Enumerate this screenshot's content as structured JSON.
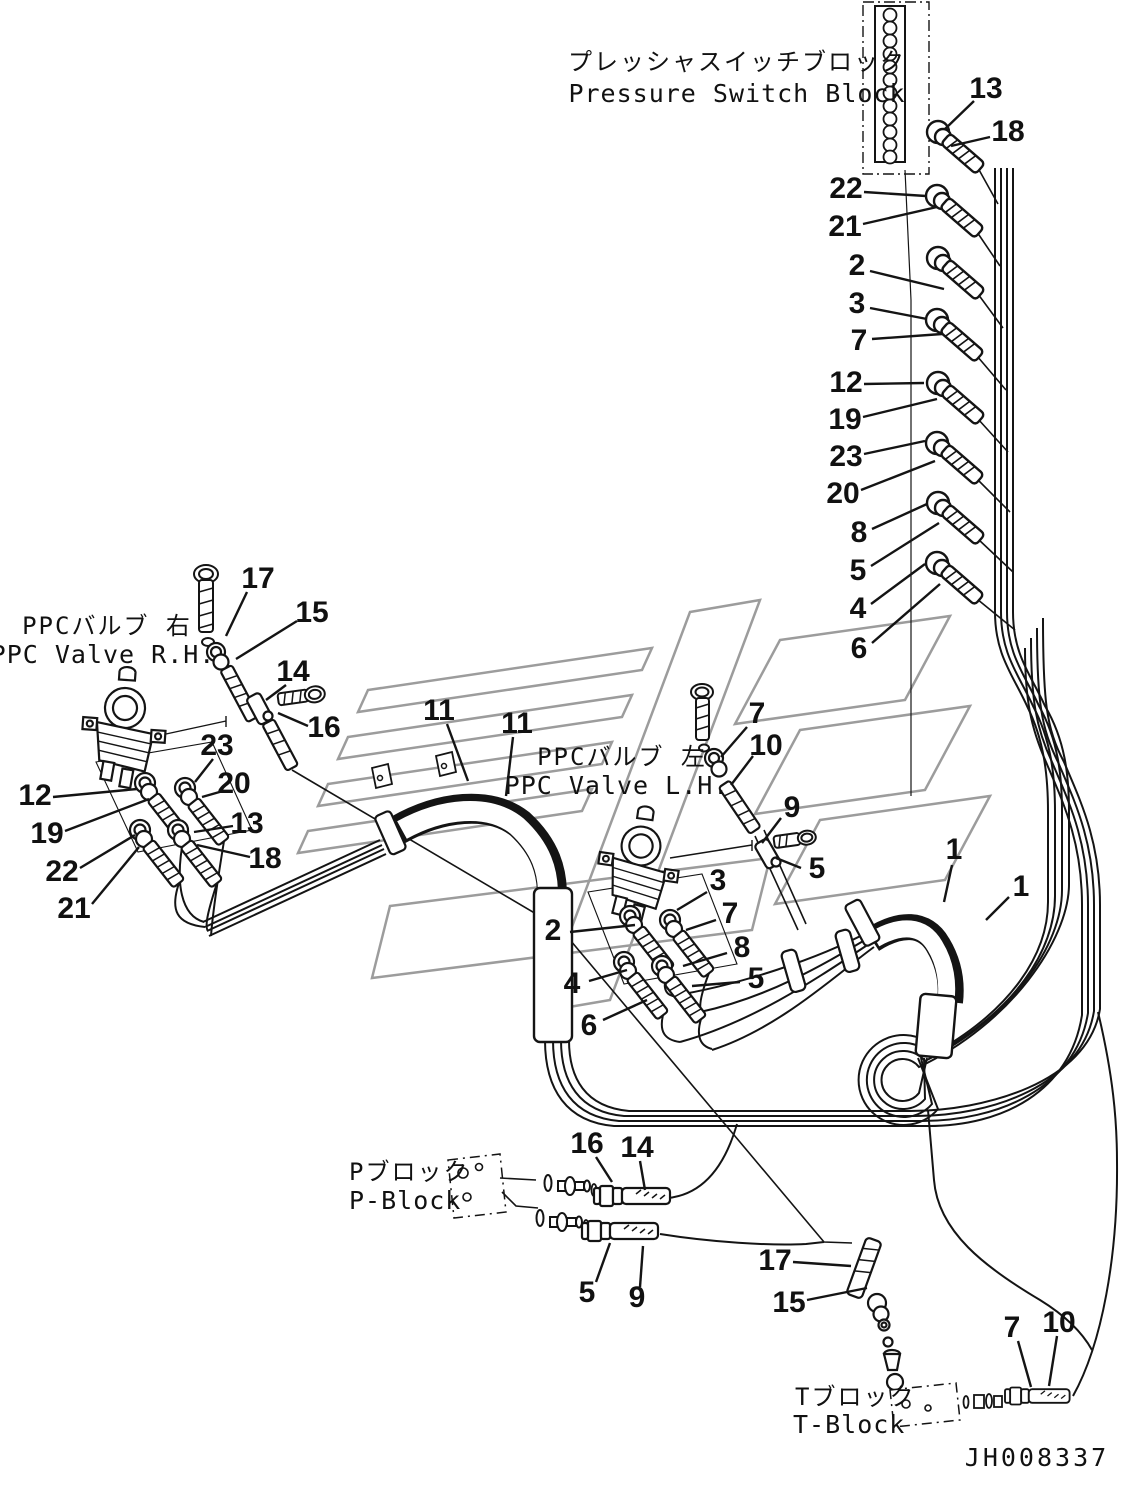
{
  "labels": {
    "pressure_switch_block_jp": "プレッシャスイッチブロック",
    "pressure_switch_block_en": "Pressure Switch Block",
    "ppc_valve_rh_jp": "PPCバルブ 右",
    "ppc_valve_rh_en": "PPC Valve R.H.",
    "ppc_valve_lh_jp": "PPCバルブ 左",
    "ppc_valve_lh_en": "PPC Valve L.H.",
    "p_block_jp": "Pブロック",
    "p_block_en": "P-Block",
    "t_block_jp": "Tブロック",
    "t_block_en": "T-Block"
  },
  "drawing_number": "JH008337",
  "colors": {
    "line": "#141414",
    "watermark": "#9c9c9c",
    "background": "#ffffff"
  },
  "callouts": [
    {
      "t": "13",
      "x": 986,
      "y": 90,
      "x1": 974,
      "y1": 101,
      "x2": 945,
      "y2": 129
    },
    {
      "t": "18",
      "x": 1008,
      "y": 133,
      "x1": 990,
      "y1": 137,
      "x2": 951,
      "y2": 146
    },
    {
      "t": "22",
      "x": 846,
      "y": 190,
      "x1": 864,
      "y1": 192,
      "x2": 926,
      "y2": 196
    },
    {
      "t": "21",
      "x": 845,
      "y": 228,
      "x1": 863,
      "y1": 224,
      "x2": 937,
      "y2": 207
    },
    {
      "t": "2",
      "x": 857,
      "y": 267,
      "x1": 870,
      "y1": 271,
      "x2": 944,
      "y2": 289
    },
    {
      "t": "3",
      "x": 857,
      "y": 305,
      "x1": 870,
      "y1": 308,
      "x2": 927,
      "y2": 319
    },
    {
      "t": "7",
      "x": 859,
      "y": 342,
      "x1": 872,
      "y1": 339,
      "x2": 942,
      "y2": 334
    },
    {
      "t": "12",
      "x": 846,
      "y": 384,
      "x1": 864,
      "y1": 384,
      "x2": 924,
      "y2": 383
    },
    {
      "t": "19",
      "x": 845,
      "y": 421,
      "x1": 863,
      "y1": 417,
      "x2": 937,
      "y2": 399
    },
    {
      "t": "23",
      "x": 846,
      "y": 458,
      "x1": 864,
      "y1": 454,
      "x2": 925,
      "y2": 441
    },
    {
      "t": "20",
      "x": 843,
      "y": 495,
      "x1": 861,
      "y1": 490,
      "x2": 935,
      "y2": 461
    },
    {
      "t": "8",
      "x": 859,
      "y": 534,
      "x1": 872,
      "y1": 529,
      "x2": 927,
      "y2": 504
    },
    {
      "t": "5",
      "x": 858,
      "y": 572,
      "x1": 871,
      "y1": 566,
      "x2": 939,
      "y2": 523
    },
    {
      "t": "4",
      "x": 858,
      "y": 610,
      "x1": 871,
      "y1": 604,
      "x2": 925,
      "y2": 564
    },
    {
      "t": "6",
      "x": 859,
      "y": 650,
      "x1": 872,
      "y1": 643,
      "x2": 940,
      "y2": 584
    },
    {
      "t": "17",
      "x": 258,
      "y": 580,
      "x1": 247,
      "y1": 592,
      "x2": 226,
      "y2": 636
    },
    {
      "t": "15",
      "x": 312,
      "y": 614,
      "x1": 297,
      "y1": 621,
      "x2": 236,
      "y2": 659
    },
    {
      "t": "14",
      "x": 293,
      "y": 673,
      "x1": 286,
      "y1": 685,
      "x2": 266,
      "y2": 700
    },
    {
      "t": "16",
      "x": 324,
      "y": 729,
      "x1": 308,
      "y1": 726,
      "x2": 278,
      "y2": 713
    },
    {
      "t": "12",
      "x": 35,
      "y": 797,
      "x1": 53,
      "y1": 797,
      "x2": 137,
      "y2": 789
    },
    {
      "t": "19",
      "x": 47,
      "y": 835,
      "x1": 65,
      "y1": 831,
      "x2": 149,
      "y2": 799
    },
    {
      "t": "22",
      "x": 62,
      "y": 873,
      "x1": 80,
      "y1": 868,
      "x2": 135,
      "y2": 835
    },
    {
      "t": "21",
      "x": 74,
      "y": 910,
      "x1": 92,
      "y1": 904,
      "x2": 139,
      "y2": 847
    },
    {
      "t": "23",
      "x": 217,
      "y": 747,
      "x1": 213,
      "y1": 759,
      "x2": 195,
      "y2": 782
    },
    {
      "t": "20",
      "x": 234,
      "y": 785,
      "x1": 223,
      "y1": 791,
      "x2": 202,
      "y2": 797
    },
    {
      "t": "13",
      "x": 247,
      "y": 825,
      "x1": 233,
      "y1": 826,
      "x2": 194,
      "y2": 832
    },
    {
      "t": "18",
      "x": 265,
      "y": 860,
      "x1": 250,
      "y1": 857,
      "x2": 197,
      "y2": 845
    },
    {
      "t": "11",
      "x": 439,
      "y": 712,
      "x1": 447,
      "y1": 724,
      "x2": 468,
      "y2": 781
    },
    {
      "t": "11",
      "x": 517,
      "y": 725,
      "x1": 513,
      "y1": 737,
      "x2": 506,
      "y2": 796
    },
    {
      "t": "7",
      "x": 757,
      "y": 715,
      "x1": 747,
      "y1": 727,
      "x2": 721,
      "y2": 757
    },
    {
      "t": "10",
      "x": 766,
      "y": 747,
      "x1": 753,
      "y1": 756,
      "x2": 731,
      "y2": 785
    },
    {
      "t": "9",
      "x": 792,
      "y": 809,
      "x1": 781,
      "y1": 818,
      "x2": 762,
      "y2": 843
    },
    {
      "t": "5",
      "x": 817,
      "y": 870,
      "x1": 801,
      "y1": 868,
      "x2": 776,
      "y2": 858
    },
    {
      "t": "3",
      "x": 718,
      "y": 882,
      "x1": 707,
      "y1": 892,
      "x2": 677,
      "y2": 910
    },
    {
      "t": "2",
      "x": 553,
      "y": 932,
      "x1": 570,
      "y1": 932,
      "x2": 635,
      "y2": 925
    },
    {
      "t": "7",
      "x": 730,
      "y": 915,
      "x1": 716,
      "y1": 920,
      "x2": 686,
      "y2": 930
    },
    {
      "t": "8",
      "x": 742,
      "y": 949,
      "x1": 727,
      "y1": 953,
      "x2": 683,
      "y2": 966
    },
    {
      "t": "4",
      "x": 572,
      "y": 985,
      "x1": 589,
      "y1": 981,
      "x2": 627,
      "y2": 970
    },
    {
      "t": "5",
      "x": 756,
      "y": 980,
      "x1": 740,
      "y1": 982,
      "x2": 692,
      "y2": 986
    },
    {
      "t": "6",
      "x": 589,
      "y": 1027,
      "x1": 603,
      "y1": 1020,
      "x2": 647,
      "y2": 1000
    },
    {
      "t": "1",
      "x": 954,
      "y": 851,
      "x1": 952,
      "y1": 865,
      "x2": 944,
      "y2": 902
    },
    {
      "t": "1",
      "x": 1021,
      "y": 888,
      "x1": 1009,
      "y1": 897,
      "x2": 986,
      "y2": 920
    },
    {
      "t": "16",
      "x": 587,
      "y": 1145,
      "x1": 596,
      "y1": 1157,
      "x2": 612,
      "y2": 1182
    },
    {
      "t": "14",
      "x": 637,
      "y": 1149,
      "x1": 640,
      "y1": 1161,
      "x2": 645,
      "y2": 1190
    },
    {
      "t": "5",
      "x": 587,
      "y": 1294,
      "x1": 596,
      "y1": 1282,
      "x2": 610,
      "y2": 1243
    },
    {
      "t": "9",
      "x": 637,
      "y": 1299,
      "x1": 640,
      "y1": 1287,
      "x2": 643,
      "y2": 1246
    },
    {
      "t": "17",
      "x": 775,
      "y": 1262,
      "x1": 793,
      "y1": 1262,
      "x2": 851,
      "y2": 1266
    },
    {
      "t": "15",
      "x": 789,
      "y": 1304,
      "x1": 807,
      "y1": 1300,
      "x2": 867,
      "y2": 1288
    },
    {
      "t": "7",
      "x": 1012,
      "y": 1329,
      "x1": 1018,
      "y1": 1341,
      "x2": 1031,
      "y2": 1387
    },
    {
      "t": "10",
      "x": 1059,
      "y": 1324,
      "x1": 1057,
      "y1": 1336,
      "x2": 1049,
      "y2": 1386
    }
  ]
}
